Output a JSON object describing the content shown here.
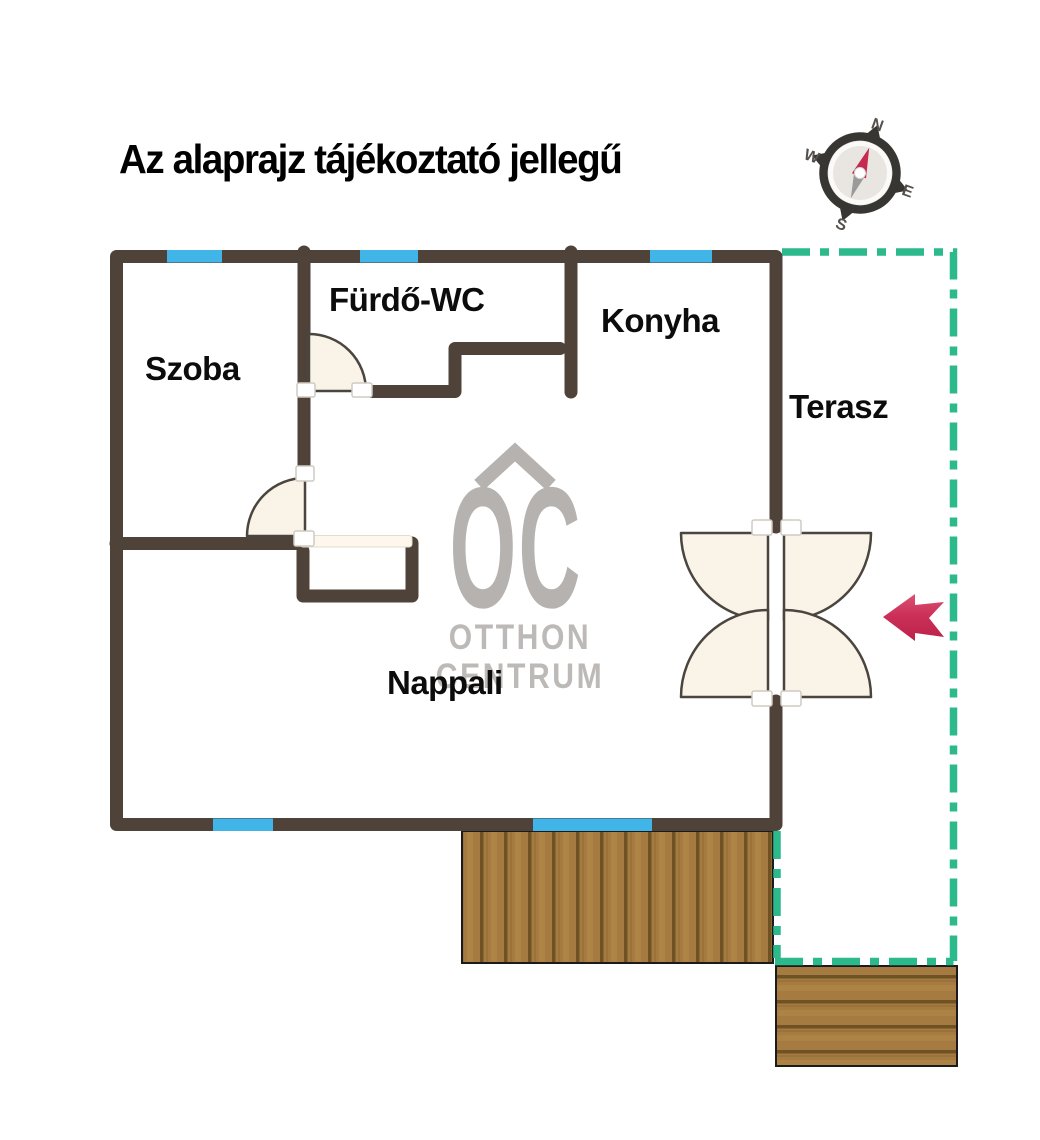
{
  "title": "Az alaprajz tájékoztató jellegű",
  "rooms": {
    "szoba": "Szoba",
    "furdo_wc": "Fürdő-WC",
    "konyha": "Konyha",
    "terasz": "Terasz",
    "nappali": "Nappali"
  },
  "watermark": {
    "monogram": "OC",
    "line1": "OTTHON",
    "line2": "CENTRUM"
  },
  "compass": {
    "north": "N",
    "east": "E",
    "south": "S",
    "west": "W"
  },
  "colors": {
    "wall_brown": "#4f4238",
    "window_blue": "#42b5e8",
    "terrace_boundary_green": "#2cb98c",
    "door_leaf_cream": "#faf3e8",
    "door_outline": "#4a453e",
    "entrance_arrow_red": "#c92b52",
    "deck_wood": "#a57b41",
    "logo_gray": "#b5b2af",
    "compass_ring": "#383633",
    "needle_red": "#c62a50",
    "needle_gray": "#9c9a98"
  }
}
